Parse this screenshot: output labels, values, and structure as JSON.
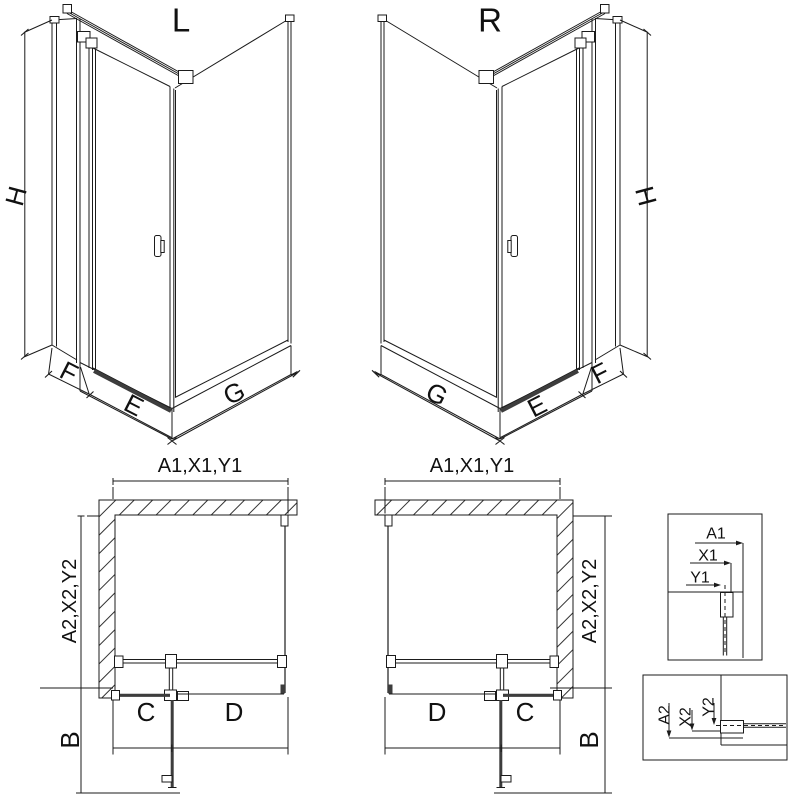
{
  "colors": {
    "line": "#1b1b1b",
    "dark": "#3d3d3d",
    "background": "#ffffff"
  },
  "views": {
    "iso_left": {
      "label": "L",
      "dim_height": "H",
      "dim_side": "F",
      "dim_door": "E",
      "dim_wall": "G"
    },
    "iso_right": {
      "label": "R",
      "dim_height": "H",
      "dim_side": "F",
      "dim_door": "E",
      "dim_wall": "G"
    },
    "plan_left": {
      "dim_width": "A1,X1,Y1",
      "dim_depth": "A2,X2,Y2",
      "dim_fixed": "C",
      "dim_door": "D",
      "dim_swing": "B"
    },
    "plan_right": {
      "dim_width": "A1,X1,Y1",
      "dim_depth": "A2,X2,Y2",
      "dim_fixed": "C",
      "dim_door": "D",
      "dim_swing": "B"
    },
    "detail_width": {
      "outer": "A1",
      "profile": "X1",
      "glass": "Y1"
    },
    "detail_depth": {
      "outer": "A2",
      "profile": "X2",
      "glass": "Y2"
    }
  }
}
